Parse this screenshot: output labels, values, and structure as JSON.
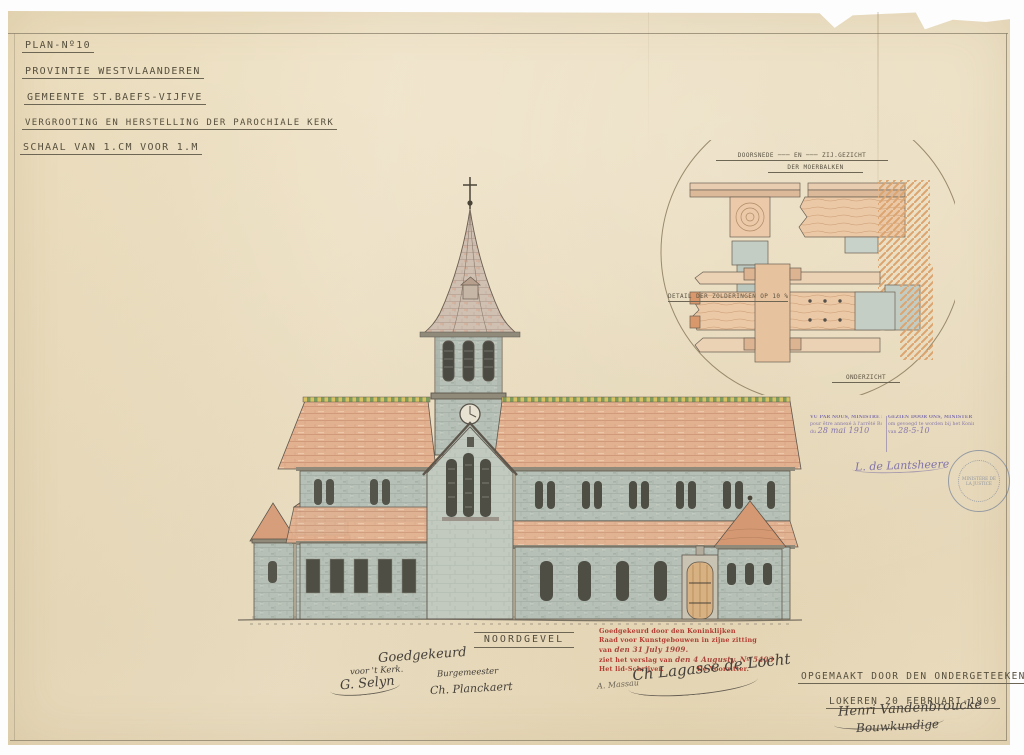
{
  "colors": {
    "paper": "#ecdfc2",
    "ink": "#57503e",
    "roof_tile": "#e2b190",
    "stone": "#b7c0b6",
    "red_stamp": "#b23c31",
    "purple_stamp": "#8577ab",
    "seal_blue": "#48608c"
  },
  "title_block": {
    "lines": [
      "PLAN-Nº10",
      "PROVINTIE WESTVLAANDEREN",
      "GEMEENTE ST.BAEFS-VIJFVE",
      "VERGROOTING EN HERSTELLING DER PAROCHIALE KERK",
      "SCHAAL VAN 1.CM VOOR 1.M"
    ]
  },
  "detail_inset": {
    "heading": "DOORSNEDE ─── EN ─── ZIJ.GEZICHT",
    "subheading": "DER MOERBALKEN",
    "left_caption": "DETAIL DER ZOLDERINGEN OP 10 %",
    "bottom_caption": "ONDERZICHT"
  },
  "elevation_caption": "NOORDGEVEL",
  "red_stamp": {
    "line1": "Goedgekeurd door den Koninklijken",
    "line2": "Raad voor Kunstgebouwen in zijne zitting",
    "line3_print": "van",
    "line3_hand": "den 31 July 1909.",
    "line4_print": "ziet het verslag van",
    "line4_hand": "den 4 Augusty. Nº 5403",
    "line5_left": "Het lid-Schrijver.",
    "line5_right": "De Voorzitter."
  },
  "ministry_stamp": {
    "fr_line1": "VU PAR NOUS, MINISTRE DE LA JUSTICE",
    "fr_line2": "pour être annexé à l'arrêté Royal",
    "fr_line3_prefix": "du",
    "fr_date": "28 mai 1910",
    "nl_line1": "GEZIEN DOOR ONS, MINISTER VAN JUSTITIE",
    "nl_line2": "om gevoegd te worden bij het Koninklijk besluit",
    "nl_line3_prefix": "van",
    "nl_date": "28-5-10",
    "signature": "L. de Lantsheere"
  },
  "round_seal_text": "MINISTÈRE DE LA JUSTICE",
  "approval_signatures": {
    "goedgekeurd": "Goedgekeurd",
    "kerk_role": "voor 't Kerk.",
    "kerk_signature": "G. Selyn",
    "burgemeester_role": "Burgemeester",
    "burgemeester_signature": "Ch. Planckaert",
    "secretary_signature": "A. Massau",
    "president_signature": "Ch Lagasse de Locht"
  },
  "statement": {
    "line1": "OPGEMAAKT DOOR DEN ONDERGETEEKENDE",
    "line2": "LOKEREN 20 FEBRUARI-1909",
    "signature_name": "Henri Vandenbroucke",
    "signature_title": "Bouwkundige"
  }
}
